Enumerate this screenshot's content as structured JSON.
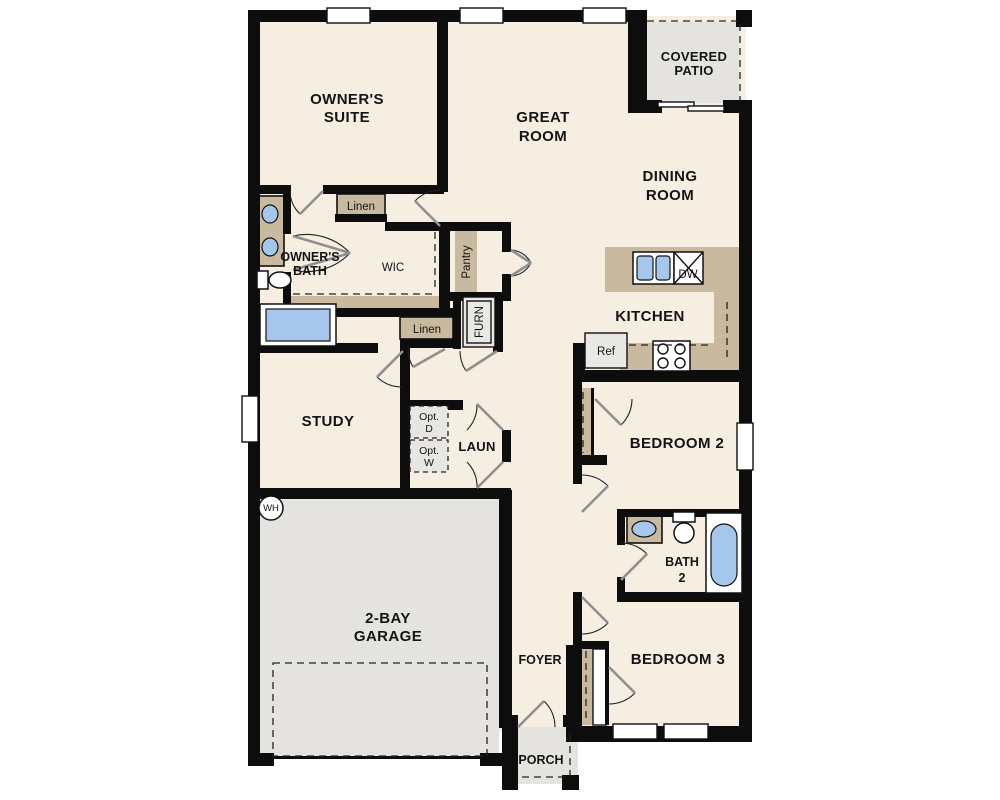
{
  "plan": {
    "rooms": {
      "owners_suite": {
        "line1": "OWNER'S",
        "line2": "SUITE"
      },
      "great_room": {
        "line1": "GREAT",
        "line2": "ROOM"
      },
      "covered_patio": {
        "line1": "COVERED",
        "line2": "PATIO"
      },
      "dining_room": {
        "line1": "DINING",
        "line2": "ROOM"
      },
      "kitchen": {
        "label": "KITCHEN"
      },
      "owners_bath": {
        "line1": "OWNER'S",
        "line2": "BATH"
      },
      "wic": {
        "label": "WIC"
      },
      "study": {
        "label": "STUDY"
      },
      "laundry": {
        "label": "LAUN"
      },
      "bedroom2": {
        "label": "BEDROOM 2"
      },
      "bath2": {
        "line1": "BATH",
        "line2": "2"
      },
      "bedroom3": {
        "label": "BEDROOM 3"
      },
      "garage": {
        "line1": "2-BAY",
        "line2": "GARAGE"
      },
      "foyer": {
        "label": "FOYER"
      },
      "porch": {
        "label": "PORCH"
      }
    },
    "closets": {
      "linen_upper": {
        "label": "Linen"
      },
      "linen_lower": {
        "label": "Linen"
      },
      "pantry": {
        "label": "Pantry"
      },
      "furnace": {
        "label": "FURN"
      }
    },
    "fixtures": {
      "refrigerator": {
        "label": "Ref"
      },
      "dishwasher": {
        "label": "DW"
      },
      "water_heater": {
        "label": "WH"
      },
      "opt_dryer": {
        "line1": "Opt.",
        "line2": "D"
      },
      "opt_washer": {
        "line1": "Opt.",
        "line2": "W"
      }
    },
    "colors": {
      "floor": "#f6eee1",
      "concrete": "#e4e3e0",
      "casework_tan": "#c9b99e",
      "water_blue": "#a6c7ec",
      "wall": "#0d0d0d"
    }
  }
}
